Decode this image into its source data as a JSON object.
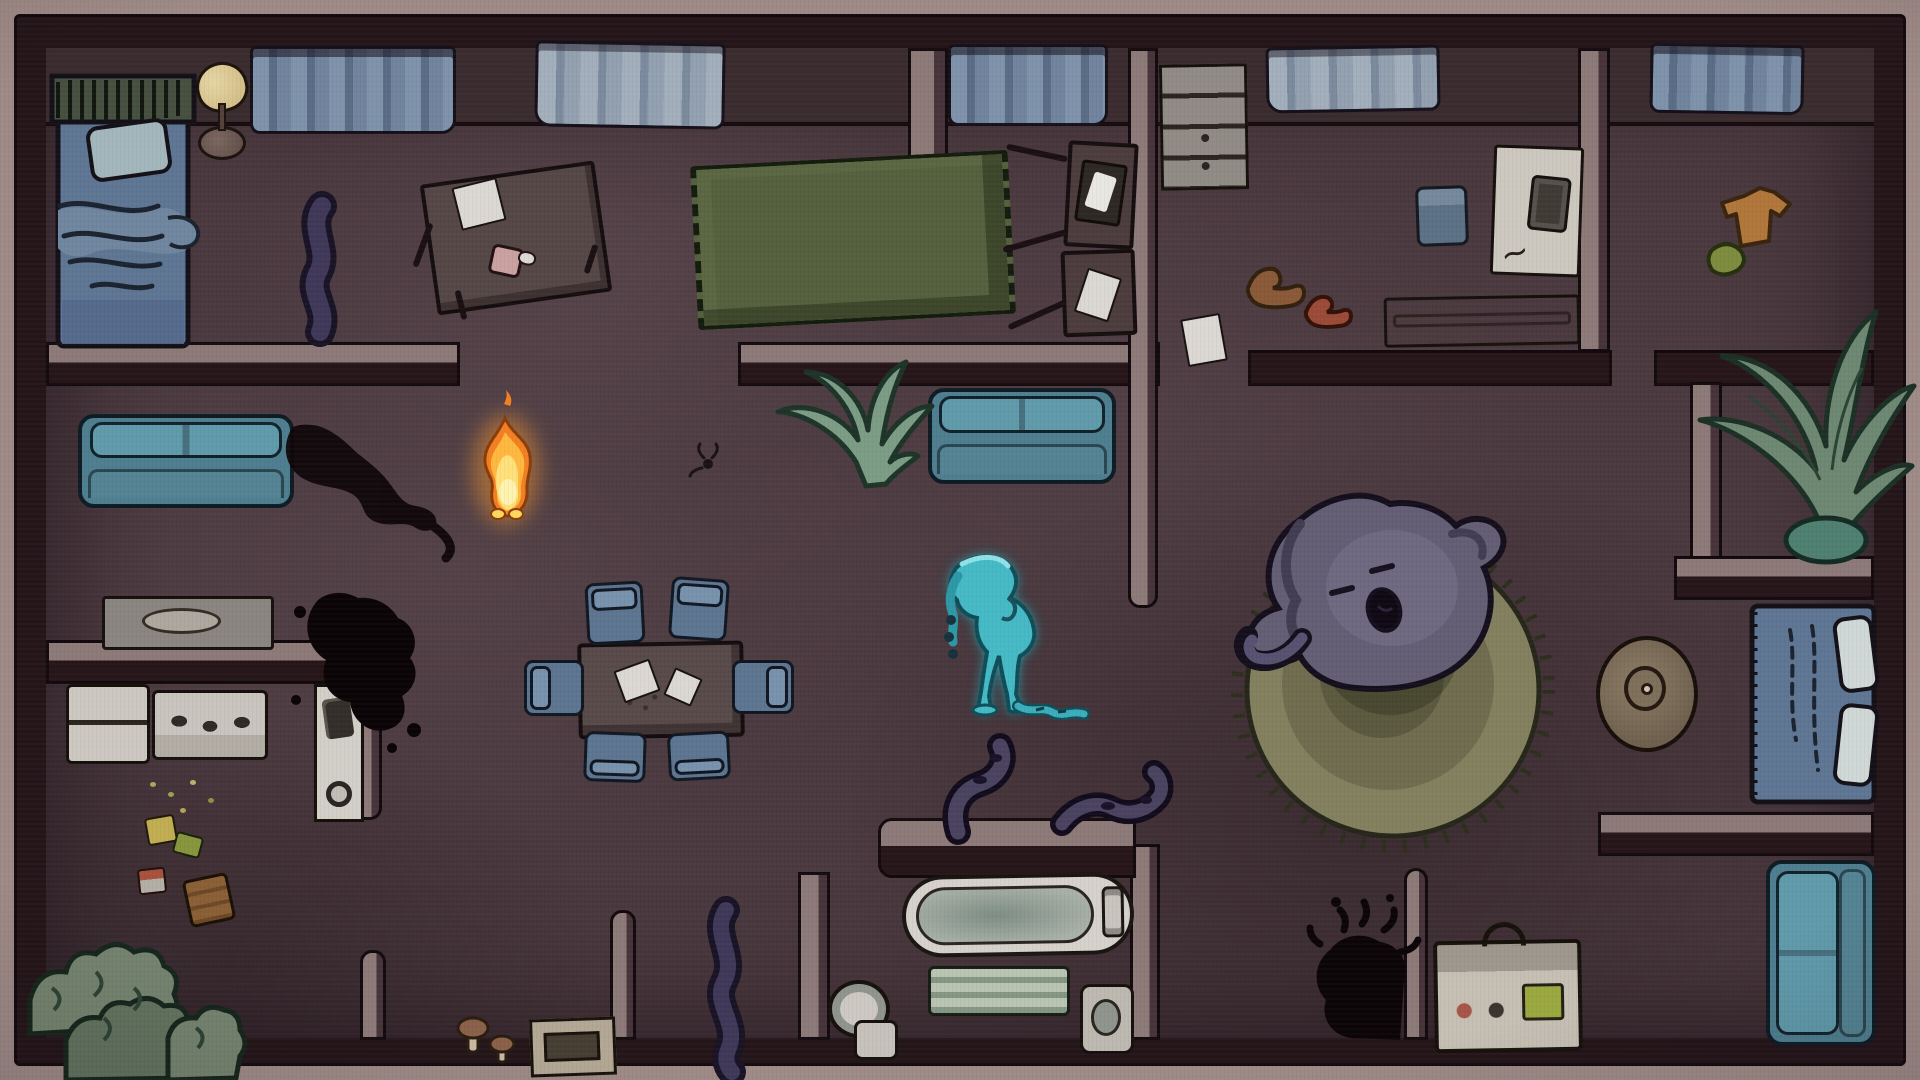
{
  "meta": {
    "scene_title": "Haunted house — top-down night scene",
    "viewport": {
      "width": 1920,
      "height": 1080
    }
  },
  "palette": {
    "outer_wall_tan": "#9e8a87",
    "wall_dark": "#241519",
    "wall_top": "#8d7a78",
    "floor": "#4a393f",
    "curtain_blue": "#7e92aa",
    "couch_teal": "#4e7e8f",
    "chair_blue": "#5d7590",
    "rug_olive": "#55603e",
    "round_rug": "#83805f",
    "flame_orange": "#f28022",
    "flame_yellow": "#ffe07a",
    "ghost_cyan": "#45bac6",
    "sleeper_grey": "#635e74",
    "ink_black": "#0c0508"
  },
  "characters": {
    "flame": {
      "name": "flame-spirit",
      "x": 478,
      "y": 404,
      "w": 52,
      "h": 114
    },
    "water_ghost": {
      "name": "water-ghost",
      "x": 938,
      "y": 550,
      "w": 150,
      "h": 168
    },
    "sleeping_ghost": {
      "name": "sleeping-ghost-on-rug",
      "x": 1242,
      "y": 496,
      "w": 270,
      "h": 200
    }
  },
  "scene": {
    "rooms": [
      {
        "name": "bedroom-top-left"
      },
      {
        "name": "living-room"
      },
      {
        "name": "kitchen"
      },
      {
        "name": "dining-area"
      },
      {
        "name": "hallway"
      },
      {
        "name": "laundry-room"
      },
      {
        "name": "bedroom-top-right"
      },
      {
        "name": "plant-nook"
      },
      {
        "name": "rug-hall"
      },
      {
        "name": "bedroom-right"
      },
      {
        "name": "bathroom"
      },
      {
        "name": "lounge-bottom-right"
      }
    ],
    "items": [
      {
        "n": "curtain",
        "t": "curtain-a",
        "x": 250,
        "y": 46,
        "w": 206,
        "h": 88
      },
      {
        "n": "curtain",
        "t": "curtain-b",
        "x": 535,
        "y": 42,
        "w": 190,
        "h": 86,
        "r": 1
      },
      {
        "n": "curtain",
        "t": "curtain-a",
        "x": 948,
        "y": 44,
        "w": 160,
        "h": 82
      },
      {
        "n": "curtain",
        "t": "curtain-b",
        "x": 1266,
        "y": 46,
        "w": 174,
        "h": 66,
        "r": -1
      },
      {
        "n": "curtain",
        "t": "curtain-a",
        "x": 1650,
        "y": 44,
        "w": 154,
        "h": 70,
        "r": 1
      },
      {
        "n": "lamp-shade",
        "t": "lamp-shade",
        "x": 196,
        "y": 62,
        "w": 52,
        "h": 50,
        "r": -15
      },
      {
        "n": "lamp-base",
        "t": "lamp-base",
        "x": 198,
        "y": 126,
        "w": 48,
        "h": 34
      },
      {
        "n": "console-table",
        "t": "console-table",
        "x": 102,
        "y": 596,
        "w": 172,
        "h": 54
      },
      {
        "n": "fridge",
        "t": "fridge",
        "x": 66,
        "y": 684,
        "w": 84,
        "h": 80
      },
      {
        "n": "stove",
        "t": "stove",
        "x": 152,
        "y": 690,
        "w": 116,
        "h": 70
      },
      {
        "n": "washer-stack",
        "t": "washer-column",
        "x": 314,
        "y": 684,
        "w": 50,
        "h": 138
      },
      {
        "n": "storage-box",
        "t": "box-tray",
        "x": 530,
        "y": 1018,
        "w": 86,
        "h": 58,
        "r": -2
      },
      {
        "n": "sofa",
        "t": "couch-h",
        "x": 78,
        "y": 414,
        "w": 216,
        "h": 94
      },
      {
        "n": "hall-couch",
        "t": "couch-h",
        "x": 928,
        "y": 388,
        "w": 188,
        "h": 96
      },
      {
        "n": "lounge-couch",
        "t": "couch-v",
        "x": 1766,
        "y": 860,
        "w": 110,
        "h": 186
      },
      {
        "n": "dining-table",
        "t": "dining-table",
        "x": 578,
        "y": 642,
        "w": 166,
        "h": 96,
        "r": -1
      },
      {
        "n": "chair",
        "t": "chair",
        "x": 586,
        "y": 582,
        "w": 58,
        "h": 62,
        "r": -3
      },
      {
        "n": "chair",
        "t": "chair",
        "x": 670,
        "y": 578,
        "w": 58,
        "h": 62,
        "r": 4
      },
      {
        "n": "chair",
        "t": "chair",
        "x": 526,
        "y": 658,
        "w": 56,
        "h": 60,
        "r": -90
      },
      {
        "n": "chair",
        "t": "chair",
        "x": 736,
        "y": 656,
        "w": 54,
        "h": 62,
        "r": 90
      },
      {
        "n": "chair",
        "t": "chair",
        "x": 584,
        "y": 732,
        "w": 62,
        "h": 50,
        "r": 182
      },
      {
        "n": "chair",
        "t": "chair",
        "x": 668,
        "y": 732,
        "w": 62,
        "h": 48,
        "r": 177
      },
      {
        "n": "table-paper",
        "t": "paper",
        "x": 618,
        "y": 664,
        "w": 38,
        "h": 34,
        "r": -20
      },
      {
        "n": "table-paper",
        "t": "paper",
        "x": 668,
        "y": 672,
        "w": 30,
        "h": 30,
        "r": 24
      },
      {
        "n": "desk",
        "t": "desk-top",
        "x": 428,
        "y": 172,
        "w": 176,
        "h": 132,
        "r": -8
      },
      {
        "n": "desk-paper",
        "t": "paper",
        "x": 456,
        "y": 182,
        "w": 46,
        "h": 44,
        "r": -14
      },
      {
        "n": "fallen-cup",
        "t": "cup",
        "x": 490,
        "y": 246,
        "w": 32,
        "h": 30,
        "r": 12
      },
      {
        "n": "desk-leg",
        "t": "leg",
        "x": 420,
        "y": 222,
        "w": 6,
        "h": 46,
        "r": 20
      },
      {
        "n": "desk-leg",
        "t": "leg",
        "x": 458,
        "y": 290,
        "w": 6,
        "h": 30,
        "r": -14
      },
      {
        "n": "desk-leg",
        "t": "leg",
        "x": 588,
        "y": 244,
        "w": 6,
        "h": 30,
        "r": 18
      },
      {
        "n": "green-rug",
        "t": "green-rug",
        "x": 694,
        "y": 158,
        "w": 318,
        "h": 164,
        "r": -3
      },
      {
        "n": "tv-stand-panel",
        "t": "panel",
        "x": 1066,
        "y": 142,
        "w": 70,
        "h": 106,
        "r": 3
      },
      {
        "n": "tv-screen",
        "t": "screen",
        "x": 1078,
        "y": 162,
        "w": 46,
        "h": 62,
        "r": 8
      },
      {
        "n": "tv-stand-panel",
        "t": "panel",
        "x": 1062,
        "y": 250,
        "w": 74,
        "h": 86,
        "r": -2
      },
      {
        "n": "stand-paper",
        "t": "paper",
        "x": 1080,
        "y": 272,
        "w": 36,
        "h": 46,
        "r": 18
      },
      {
        "n": "stand-leg",
        "t": "leg",
        "x": 1006,
        "y": 150,
        "w": 62,
        "h": 6,
        "r": 12
      },
      {
        "n": "stand-leg",
        "t": "leg",
        "x": 1002,
        "y": 238,
        "w": 66,
        "h": 6,
        "r": -16
      },
      {
        "n": "stand-leg",
        "t": "leg",
        "x": 1006,
        "y": 312,
        "w": 62,
        "h": 6,
        "r": -24
      },
      {
        "n": "floor-paper",
        "t": "paper",
        "x": 1184,
        "y": 316,
        "w": 40,
        "h": 48,
        "r": -10
      },
      {
        "n": "dresser",
        "t": "dresser",
        "x": 1160,
        "y": 64,
        "w": 88,
        "h": 126,
        "r": -1
      },
      {
        "n": "laundry-bin",
        "t": "blue-bin",
        "x": 1416,
        "y": 186,
        "w": 52,
        "h": 60,
        "r": -2
      },
      {
        "n": "washing-machine",
        "t": "wash-machine-big",
        "x": 1492,
        "y": 146,
        "w": 90,
        "h": 130,
        "r": 2
      },
      {
        "n": "bench",
        "t": "bench2",
        "x": 1384,
        "y": 296,
        "w": 196,
        "h": 50,
        "r": -1
      },
      {
        "n": "pouf",
        "t": "pouf",
        "x": 1596,
        "y": 636,
        "w": 102,
        "h": 116
      },
      {
        "n": "bathtub",
        "t": "bathtub",
        "x": 902,
        "y": 874,
        "w": 232,
        "h": 82,
        "r": -1
      },
      {
        "n": "radiator",
        "t": "radiator",
        "x": 928,
        "y": 966,
        "w": 142,
        "h": 50
      },
      {
        "n": "toilet",
        "t": "toilet",
        "x": 828,
        "y": 980,
        "w": 76,
        "h": 80
      },
      {
        "n": "sink",
        "t": "sink2",
        "x": 1080,
        "y": 984,
        "w": 54,
        "h": 70
      },
      {
        "n": "boombox",
        "t": "boombox",
        "x": 1434,
        "y": 940,
        "w": 148,
        "h": 112,
        "r": -1
      },
      {
        "n": "trash-piece",
        "t": "trash-y",
        "x": 146,
        "y": 816,
        "w": 30,
        "h": 28,
        "r": -10
      },
      {
        "n": "trash-piece",
        "t": "trash-g",
        "x": 174,
        "y": 834,
        "w": 28,
        "h": 22,
        "r": 15
      },
      {
        "n": "trash-can-small",
        "t": "trash-r",
        "x": 138,
        "y": 868,
        "w": 28,
        "h": 26,
        "r": -6
      },
      {
        "n": "trash-can",
        "t": "trash-b",
        "x": 186,
        "y": 876,
        "w": 46,
        "h": 48,
        "r": -12
      },
      {
        "n": "crumbs",
        "t": "crumbs",
        "x": 150,
        "y": 782,
        "w": 80,
        "h": 40
      }
    ]
  }
}
